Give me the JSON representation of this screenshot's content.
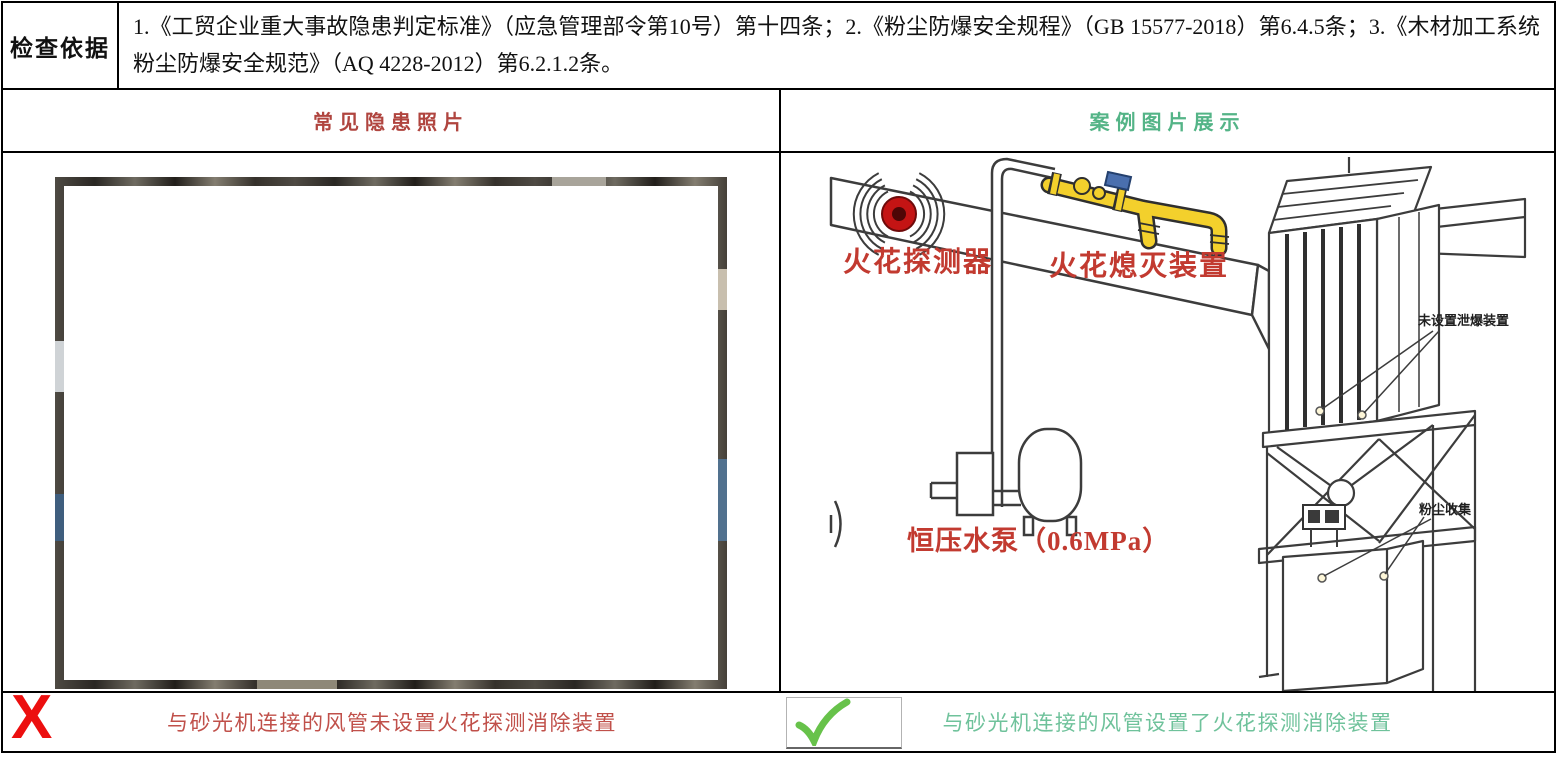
{
  "inspection": {
    "label": "检查依据",
    "text": "1.《工贸企业重大事故隐患判定标准》（应急管理部令第10号）第十四条；2.《粉尘防爆安全规程》（GB 15577-2018）第6.4.5条；3.《木材加工系统粉尘防爆安全规范》（AQ 4228-2012）第6.2.1.2条。"
  },
  "columns": {
    "hazard_header": "常见隐患照片",
    "case_header": "案例图片展示"
  },
  "captions": {
    "hazard": "与砂光机连接的风管未设置火花探测消除装置",
    "case": "与砂光机连接的风管设置了火花探测消除装置"
  },
  "marks": {
    "fail": "X"
  },
  "diagram": {
    "spark_detector": "火花探测器",
    "spark_extinguisher": "火花熄灭装置",
    "water_pump": "恒压水泵（0.6MPa）",
    "no_vent_device": "未设置泄爆装置",
    "dust_collection": "粉尘收集"
  },
  "colors": {
    "header_red": "#b0453f",
    "header_green": "#54b487",
    "caption_red": "#c0504a",
    "caption_green": "#6fc29b",
    "x_red": "#ec0f0f",
    "check_green": "#67c24a",
    "diagram_red": "#c23a30",
    "annotation_dark": "#1f1f1f",
    "device_yellow": "#f3d02c",
    "device_blue": "#4a6fae",
    "detector_red": "#c41414",
    "line_dark": "#3c3c3c"
  }
}
